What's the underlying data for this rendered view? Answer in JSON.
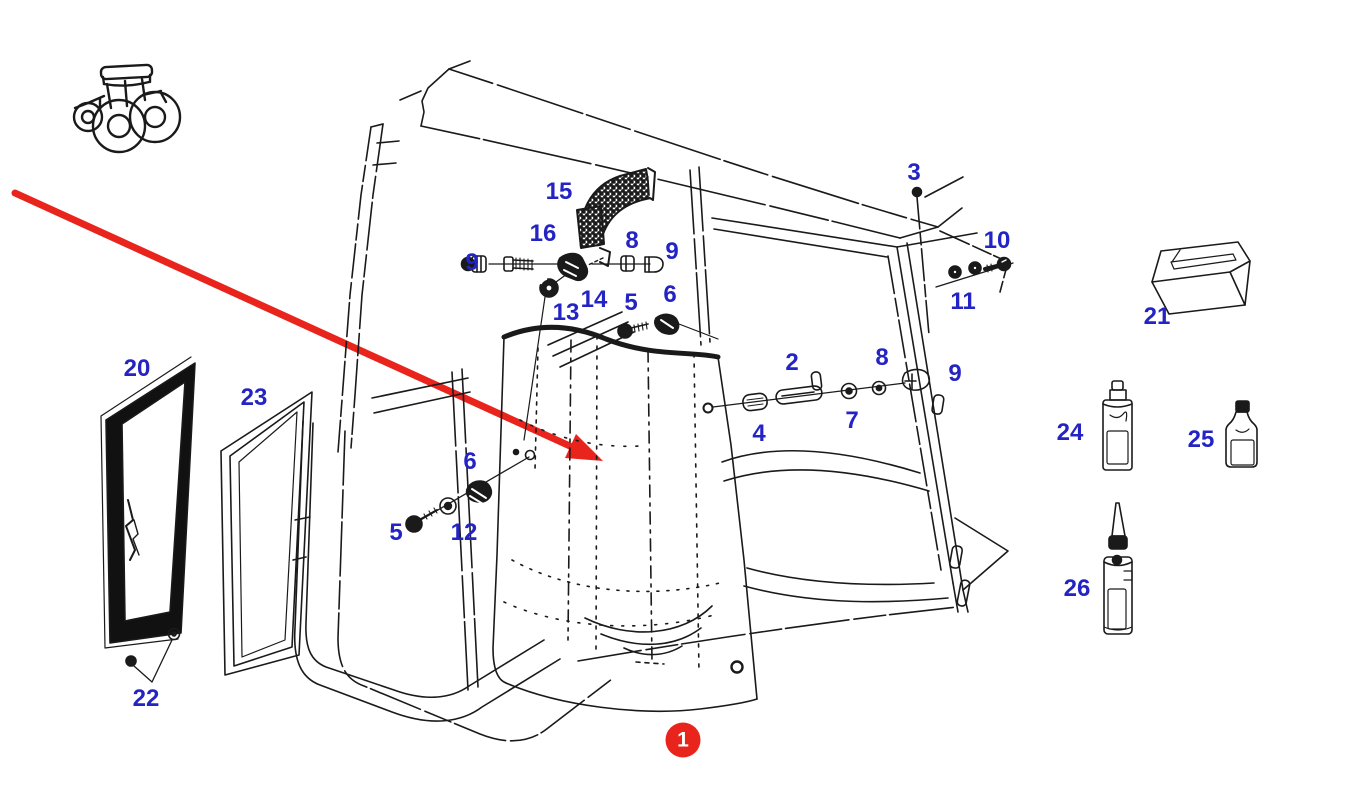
{
  "diagram": {
    "kind": "exploded-parts-diagram",
    "visible_part_numbers": [
      "1",
      "2",
      "3",
      "4",
      "5",
      "6",
      "7",
      "8",
      "9",
      "10",
      "11",
      "12",
      "13",
      "14",
      "15",
      "16",
      "20",
      "21",
      "22",
      "23",
      "24",
      "25",
      "26"
    ]
  },
  "colors": {
    "label_blue": "#2424c4",
    "arrow_red": "#e8241c",
    "badge_red": "#e8241c",
    "badge_text": "#ffffff",
    "line_black": "#1a1a1a",
    "background": "#ffffff"
  },
  "badge": {
    "label": "1",
    "x": 683,
    "y": 740
  },
  "callouts": [
    {
      "label": "15",
      "x": 559,
      "y": 192
    },
    {
      "label": "16",
      "x": 543,
      "y": 234
    },
    {
      "label": "9",
      "x": 472,
      "y": 263
    },
    {
      "label": "8",
      "x": 632,
      "y": 241
    },
    {
      "label": "9",
      "x": 672,
      "y": 252
    },
    {
      "label": "13",
      "x": 566,
      "y": 313
    },
    {
      "label": "14",
      "x": 594,
      "y": 300
    },
    {
      "label": "5",
      "x": 631,
      "y": 303
    },
    {
      "label": "6",
      "x": 670,
      "y": 295
    },
    {
      "label": "3",
      "x": 914,
      "y": 173
    },
    {
      "label": "10",
      "x": 997,
      "y": 241
    },
    {
      "label": "11",
      "x": 963,
      "y": 302
    },
    {
      "label": "2",
      "x": 792,
      "y": 363
    },
    {
      "label": "8",
      "x": 882,
      "y": 358
    },
    {
      "label": "9",
      "x": 955,
      "y": 374
    },
    {
      "label": "4",
      "x": 759,
      "y": 434
    },
    {
      "label": "7",
      "x": 852,
      "y": 421
    },
    {
      "label": "20",
      "x": 137,
      "y": 369
    },
    {
      "label": "23",
      "x": 254,
      "y": 398
    },
    {
      "label": "6",
      "x": 470,
      "y": 462
    },
    {
      "label": "5",
      "x": 396,
      "y": 533
    },
    {
      "label": "12",
      "x": 464,
      "y": 533
    },
    {
      "label": "22",
      "x": 146,
      "y": 699
    },
    {
      "label": "21",
      "x": 1157,
      "y": 317
    },
    {
      "label": "24",
      "x": 1070,
      "y": 433
    },
    {
      "label": "25",
      "x": 1201,
      "y": 440
    },
    {
      "label": "26",
      "x": 1077,
      "y": 589
    }
  ]
}
